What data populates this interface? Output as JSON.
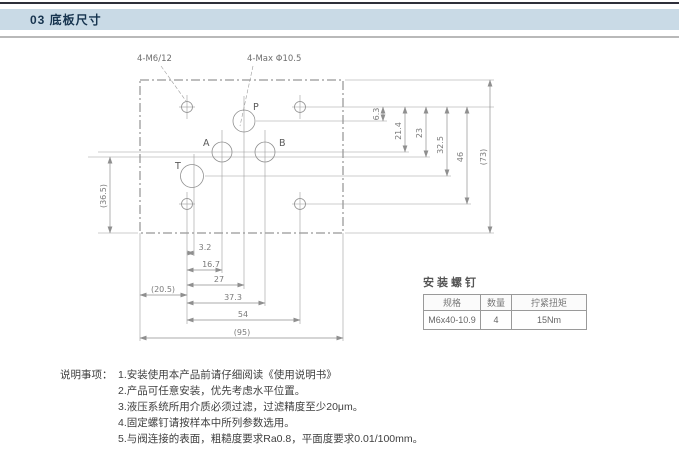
{
  "header": {
    "title": "03 底板尺寸"
  },
  "drawing": {
    "callouts": {
      "screw_holes": "4-M6/12",
      "max_port": "4-Max Φ10.5"
    },
    "ports": {
      "p": "P",
      "a": "A",
      "b": "B",
      "t": "T"
    },
    "dims_right": [
      "6.3",
      "21.4",
      "23",
      "32.5",
      "46",
      "(73)"
    ],
    "dim_left": "(36.5)",
    "dims_bottom": [
      "3.2",
      "16.7",
      "27",
      "37.3",
      "(20.5)",
      "54",
      "(95)"
    ]
  },
  "table": {
    "title": "安装螺钉",
    "headers": [
      "规格",
      "数量",
      "拧紧扭矩"
    ],
    "rows": [
      [
        "M6x40-10.9",
        "4",
        "15Nm"
      ]
    ]
  },
  "notes": {
    "label": "说明事项：",
    "items": [
      "1.安装使用本产品前请仔细阅读《使用说明书》",
      "2.产品可任意安装，优先考虑水平位置。",
      "3.液压系统所用介质必须过滤，过滤精度至少20μm。",
      "4.固定螺钉请按样本中所列参数选用。",
      "5.与阀连接的表面，粗糙度要求Ra0.8，平面度要求0.01/100mm。"
    ]
  }
}
